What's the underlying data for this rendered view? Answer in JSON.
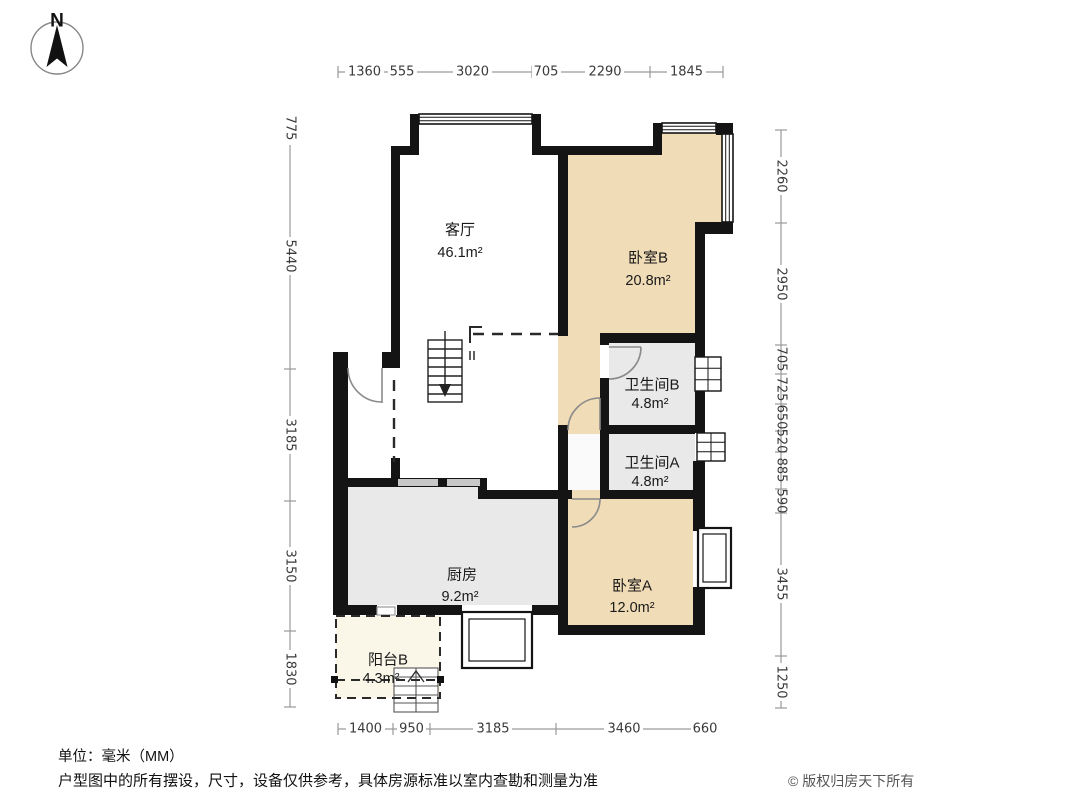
{
  "meta": {
    "north_label": "N",
    "unit_note": "单位：毫米（MM）",
    "disclaimer": "户型图中的所有摆设，尺寸，设备仅供参考，具体房源标准以室内查勘和测量为准",
    "copyright": "© 版权归房天下所有"
  },
  "colors": {
    "wall": "#141414",
    "bedroom_fill": "#f0dcb6",
    "gray_room_fill": "#e9e9e9",
    "balcony_fill": "#fbf7e8",
    "dim_line": "#9a9a9a",
    "dim_text": "#3a3a3a"
  },
  "rooms": {
    "living": {
      "name": "客厅",
      "area": "46.1m²"
    },
    "bedroom_b": {
      "name": "卧室B",
      "area": "20.8m²"
    },
    "bath_b": {
      "name": "卫生间B",
      "area": "4.8m²"
    },
    "bath_a": {
      "name": "卫生间A",
      "area": "4.8m²"
    },
    "kitchen": {
      "name": "厨房",
      "area": "9.2m²"
    },
    "bedroom_a": {
      "name": "卧室A",
      "area": "12.0m²"
    },
    "balcony_b": {
      "name": "阳台B",
      "area": "4.3m²"
    }
  },
  "dimensions": {
    "top": [
      "1360",
      "555",
      "3020",
      "705",
      "2290",
      "1845"
    ],
    "bottom": [
      "1400",
      "950",
      "3185",
      "3460",
      "660"
    ],
    "left": [
      "775",
      "5440",
      "3185",
      "3150",
      "1830"
    ],
    "right": [
      "2260",
      "2950",
      "705",
      "725",
      "650",
      "520",
      "885",
      "590",
      "3455",
      "1250"
    ]
  }
}
